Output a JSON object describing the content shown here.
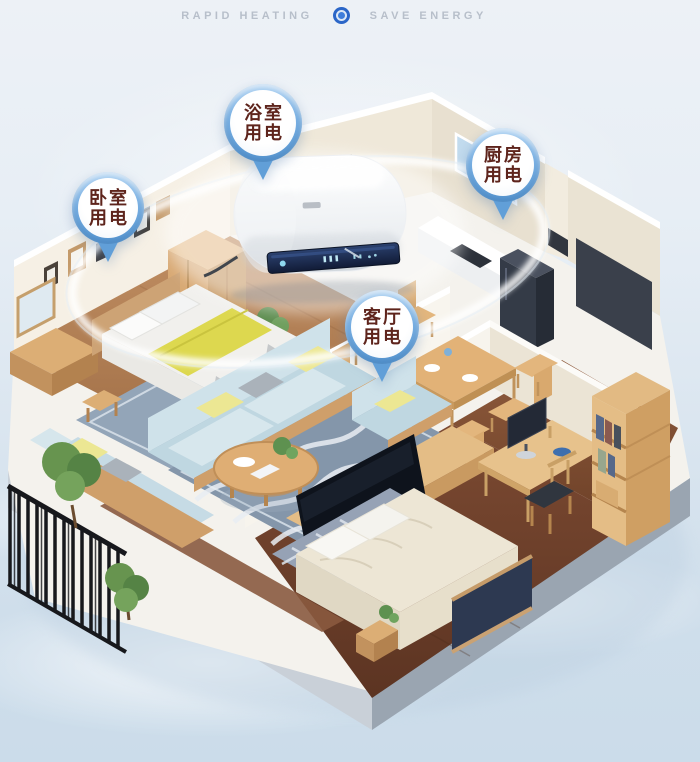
{
  "banner": {
    "left_label": "RAPID HEATING",
    "right_label": "SAVE ENERGY"
  },
  "callouts": {
    "bedroom": {
      "line1": "卧室",
      "line2": "用电"
    },
    "bathroom": {
      "line1": "浴室",
      "line2": "用电"
    },
    "kitchen": {
      "line1": "厨房",
      "line2": "用电"
    },
    "living": {
      "line1": "客厅",
      "line2": "用电"
    }
  },
  "colors": {
    "sky_top": "#edf1f6",
    "sky_bottom": "#cbdcea",
    "pin_blue": "#5d9cd7",
    "pin_blue_light": "#aed2f2",
    "pin_text_maroon": "#5e241c",
    "banner_text_gray": "#b7bfca",
    "banner_icon_blue": "#2b66c8",
    "heater_panel_navy": "#16223f",
    "accent_wall_charcoal": "#3a404b",
    "sofa_blue": "#c6dbe5",
    "wood_light": "#dcae75",
    "wood_floor": "#a06c46",
    "wood_floor_dark": "#6b4130",
    "rug_blue_gray": "#8496aa",
    "pillow_yellow": "#ece793",
    "plant_green": "#5e9150"
  },
  "scene": {
    "description": "isometric-apartment-cutaway",
    "rooms": [
      "bedroom",
      "bathroom",
      "kitchen",
      "living-room",
      "dining-area",
      "second-bedroom",
      "study",
      "balcony"
    ],
    "product": "wall-mounted-water-heater"
  }
}
